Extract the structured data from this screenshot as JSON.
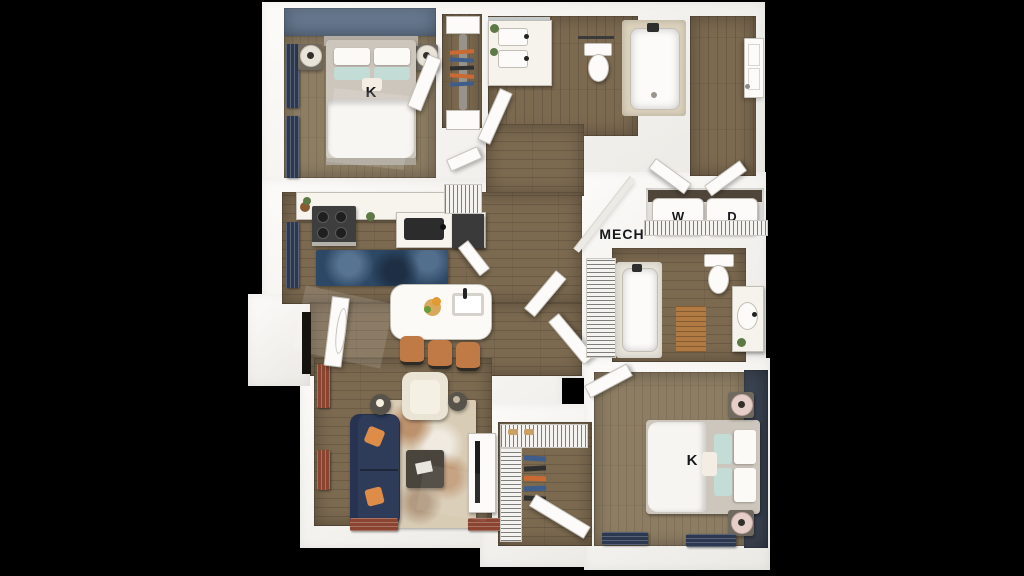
{
  "meta": {
    "description": "3D top-down rendered floor plan of a two-bedroom, two-bath apartment on a black background"
  },
  "labels": {
    "bedroom1_bed": "K",
    "bedroom2_bed": "K",
    "washer": "W",
    "dryer": "D",
    "mechanical_room": "MECH"
  },
  "palette": {
    "background": "#000000",
    "wall_white": "#f4f3f0",
    "wood_floor": "#7b6950",
    "bedroom_floor": "#8d7d63",
    "accent_wall_bedroom1": "#66788f",
    "accent_wall_bedroom2": "#3a4350",
    "curtain_navy": "#2c3750",
    "curtain_rust": "#8a4430",
    "sofa_navy": "#2e3b59",
    "pillow_orange": "#de8d48",
    "stool_leather": "#c07a45",
    "kitchen_rug_blue": "#2c4865",
    "living_rug_beige": "#d9ccb5",
    "teal_pillow": "#c3dcd6"
  }
}
